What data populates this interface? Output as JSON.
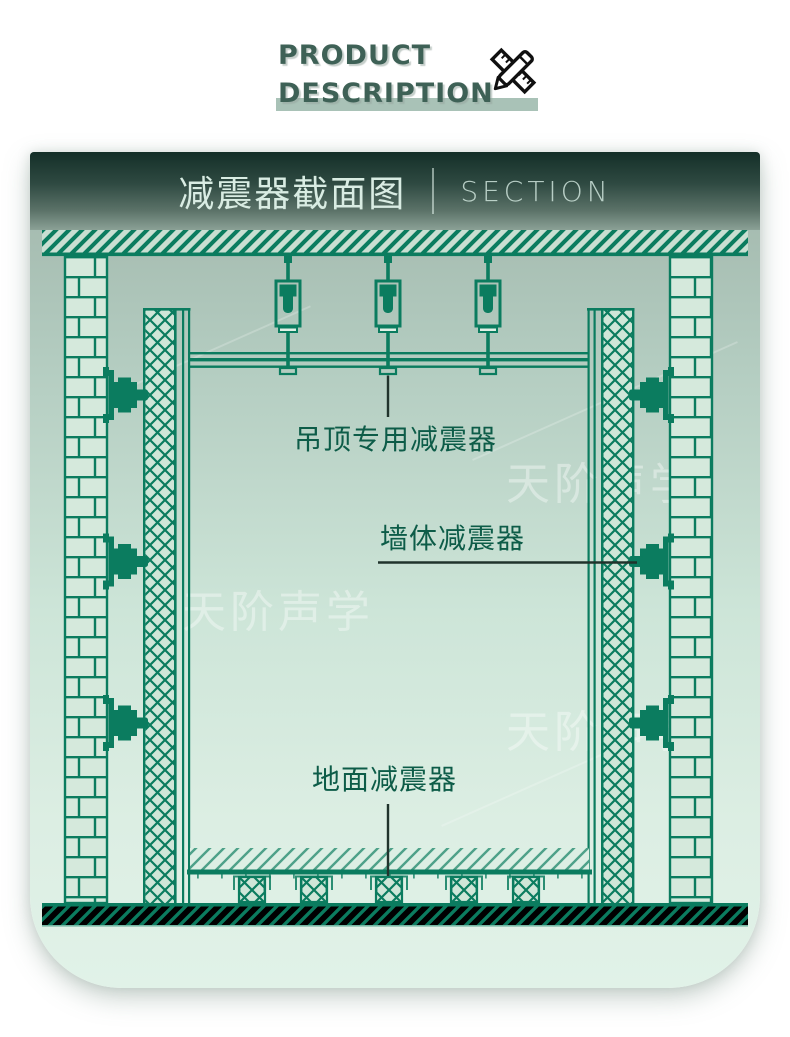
{
  "page": {
    "background": "#ffffff"
  },
  "header": {
    "line1": "PRODUCT",
    "line2": "DESCRIPTION",
    "icon": "pencil-ruler-icon",
    "text_color": "#3e6156",
    "underline_color": "#a9c2b7"
  },
  "card": {
    "banner": {
      "title_cn": "减震器截面图",
      "title_en": "SECTION",
      "bg_top": "#142f28",
      "bg_bottom": "#8ba196",
      "text_color": "#d9ece3"
    },
    "watermarks": [
      "天阶声学",
      "天阶声学",
      "天阶声学"
    ],
    "diagram": {
      "line_color": "#0b7c5f",
      "leader_color": "#20332c",
      "labels": [
        {
          "text": "吊顶专用减震器",
          "target": "ceiling-damper"
        },
        {
          "text": "墙体减震器",
          "target": "wall-damper"
        },
        {
          "text": "地面减震器",
          "target": "floor-damper"
        }
      ],
      "counts": {
        "ceiling_hangers": 3,
        "wall_dampers_per_side": 3,
        "floor_dampers": 5
      }
    }
  }
}
